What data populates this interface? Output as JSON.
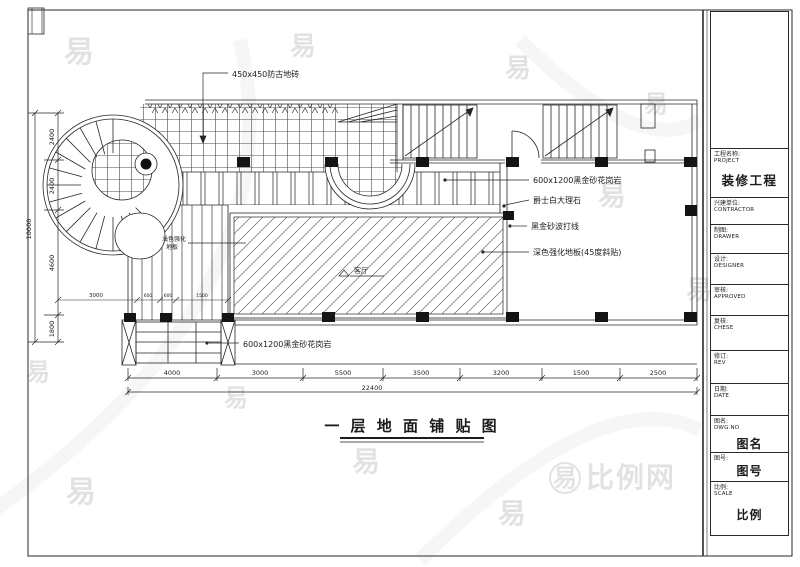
{
  "titleblock": {
    "rows": [
      {
        "label": "",
        "sub": "",
        "big": ""
      },
      {
        "label": "工程名称:",
        "sub": "PROJECT",
        "big": "装修工程"
      },
      {
        "label": "兴建单位:",
        "sub": "CONTRACTOR",
        "big": ""
      },
      {
        "label": "制图:",
        "sub": "DRAWER",
        "big": ""
      },
      {
        "label": "设计:",
        "sub": "DESIGNER",
        "big": ""
      },
      {
        "label": "审核:",
        "sub": "APPROVED",
        "big": ""
      },
      {
        "label": "复核:",
        "sub": "CHESE",
        "big": ""
      },
      {
        "label": "修订:",
        "sub": "REV",
        "big": ""
      },
      {
        "label": "日期:",
        "sub": "DATE",
        "big": ""
      },
      {
        "label": "图名:",
        "sub": "DWG.NO",
        "big": "图名"
      },
      {
        "label": "图号:",
        "sub": "DWG.NO",
        "big": "图号"
      },
      {
        "label": "比例:",
        "sub": "SCALE",
        "big": "比例"
      }
    ]
  },
  "drawing": {
    "title": "一 层 地 面 铺 贴 图",
    "annotations": {
      "tile450": "450x450防古地砖",
      "granite_top": "600x1200黑金砂花岗岩",
      "marble": "爵士白大理石",
      "border_line": "黑金砂波打线",
      "laminate": "深色强化地板(45度斜贴)",
      "granite_bottom": "600x1200黑金砂花岗岩",
      "corridor_line1": "浅色强化",
      "corridor_line2": "地板",
      "room_label": "客厅"
    },
    "dims": {
      "bottom": [
        "4000",
        "3000",
        "5500",
        "3500",
        "3200",
        "1500",
        "2500"
      ],
      "bottom_total": "22400",
      "left": [
        "2400",
        "2400",
        "4600",
        "1800"
      ],
      "left_total": "10000",
      "small_3000": "3000",
      "small_600a": "600",
      "small_600b": "600",
      "small_1500": "1500"
    }
  },
  "watermark": {
    "logo": "易",
    "site": "比例网"
  },
  "colors": {
    "line": "#1c1c1c",
    "paper": "#ffffff",
    "watermark": "#cccccc"
  }
}
